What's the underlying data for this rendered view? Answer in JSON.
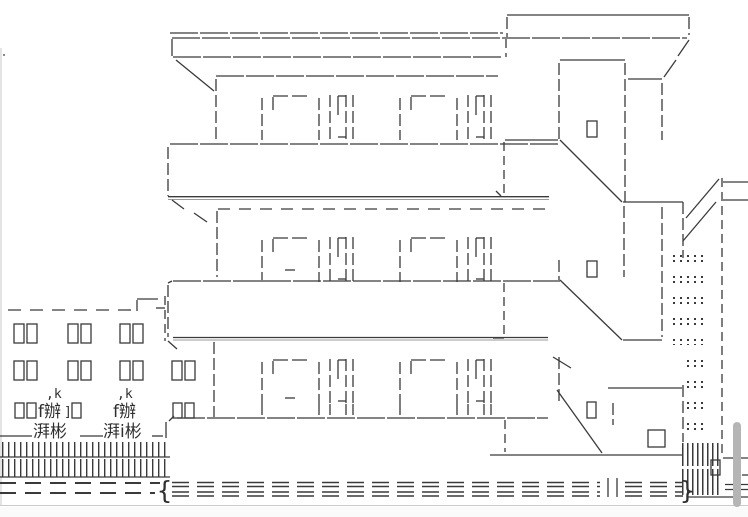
{
  "page": {
    "background": "#ffffff",
    "frame_border_color": "#c9c9c9",
    "art_line_color": "#3a3a3a",
    "scrollbar": {
      "visible": true,
      "thumb_color": "#b5b5b5"
    }
  },
  "art": {
    "description": "Shift-JIS style ASCII art of a three-story apartment building with a staircase tower on the right, balconies, a low annex building with windows on the left, trees and hedges, a fence and a road in front",
    "glyphs": {
      "tree_top_left": ",k",
      "tree_top_right": ",k",
      "bush_left": "f辦",
      "bush_bracket": "]",
      "bush_right": "f辦",
      "shrub_left": "湃彬",
      "shrub_right": "湃i彬",
      "road_open_brace": "{",
      "road_close_brace": "}"
    }
  }
}
